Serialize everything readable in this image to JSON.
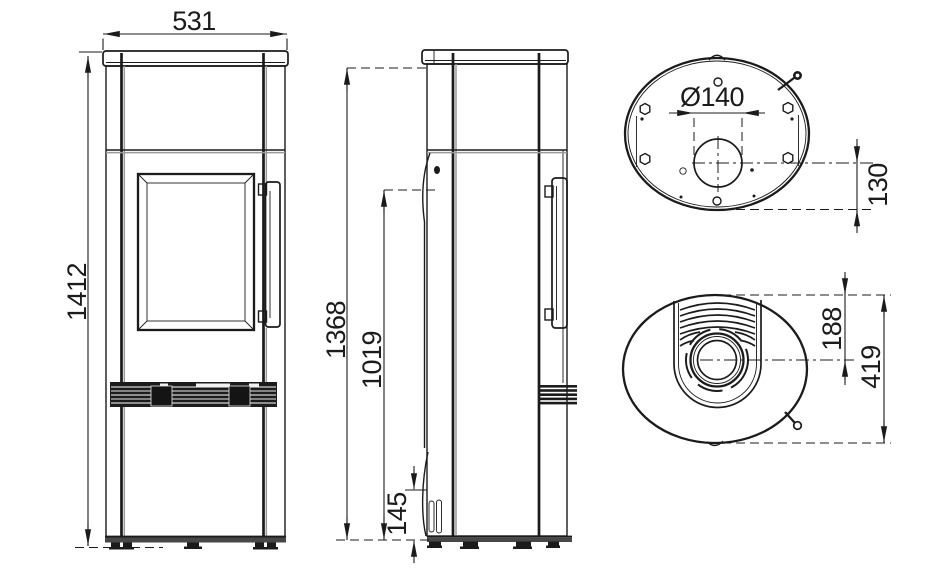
{
  "drawing": {
    "dims": {
      "front_width": "531",
      "front_height": "1412",
      "side_height_body_top": "1368",
      "side_height_rear_outlet": "1019",
      "side_bottom_detail": "145",
      "flue_diameter": "Ø140",
      "flue_center_to_rear": "130",
      "front_to_flue_center": "188",
      "depth": "419"
    },
    "colors": {
      "line": "#1b1b1b",
      "background": "#ffffff"
    }
  }
}
